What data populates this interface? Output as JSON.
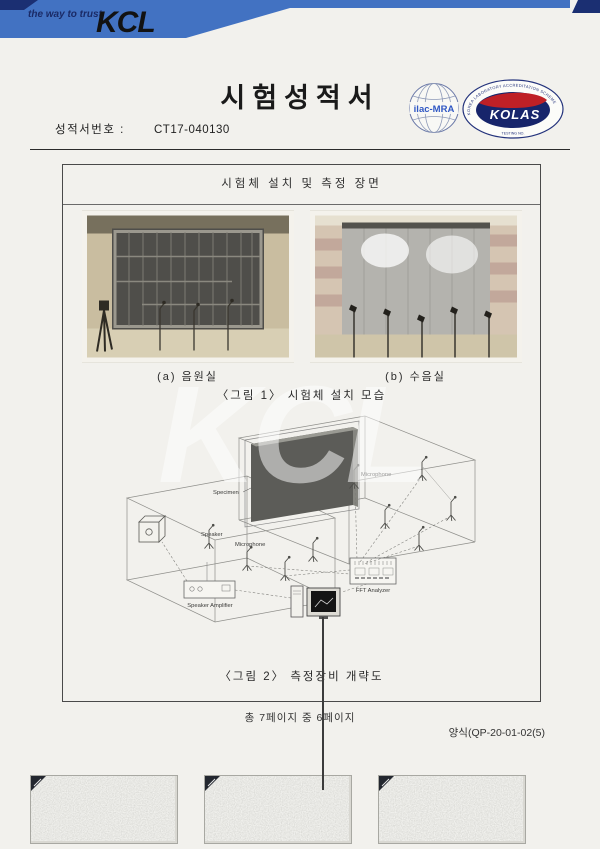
{
  "header": {
    "tagline": "the way to trust",
    "logo_text": "KCL",
    "banner_color": "#4272c2",
    "accent_navy": "#1b2f72"
  },
  "title": "시험성적서",
  "report": {
    "label": "성적서번호 :",
    "number": "CT17-040130"
  },
  "certifications": {
    "ilac_text": "ilac-MRA",
    "kolas_text": "KOLAS",
    "kolas_ring_text": "KOREA LABORATORY ACCREDITATION SCHEME",
    "kolas_bottom_text": "TESTING NO."
  },
  "figure_section": {
    "header": "시험체 설치 및 측정 장면",
    "photo_a_caption": "(a) 음원실",
    "photo_b_caption": "(b) 수음실",
    "figure1_caption": "〈그림 1〉 시험체 설치 모습",
    "figure2_caption": "〈그림 2〉 측정장비 개략도"
  },
  "diagram_labels": {
    "specimen": "Specimen",
    "microphone_receiving": "Microphone",
    "microphone_source": "Microphone",
    "speaker": "Speaker",
    "fft_analyzer": "FFT Analyzer",
    "speaker_amplifier": "Speaker Amplifier"
  },
  "watermark": "KCL",
  "footer": {
    "page_info": "총 7페이지 중 6페이지",
    "form_number": "양식(QP-20-01-02(5)"
  }
}
